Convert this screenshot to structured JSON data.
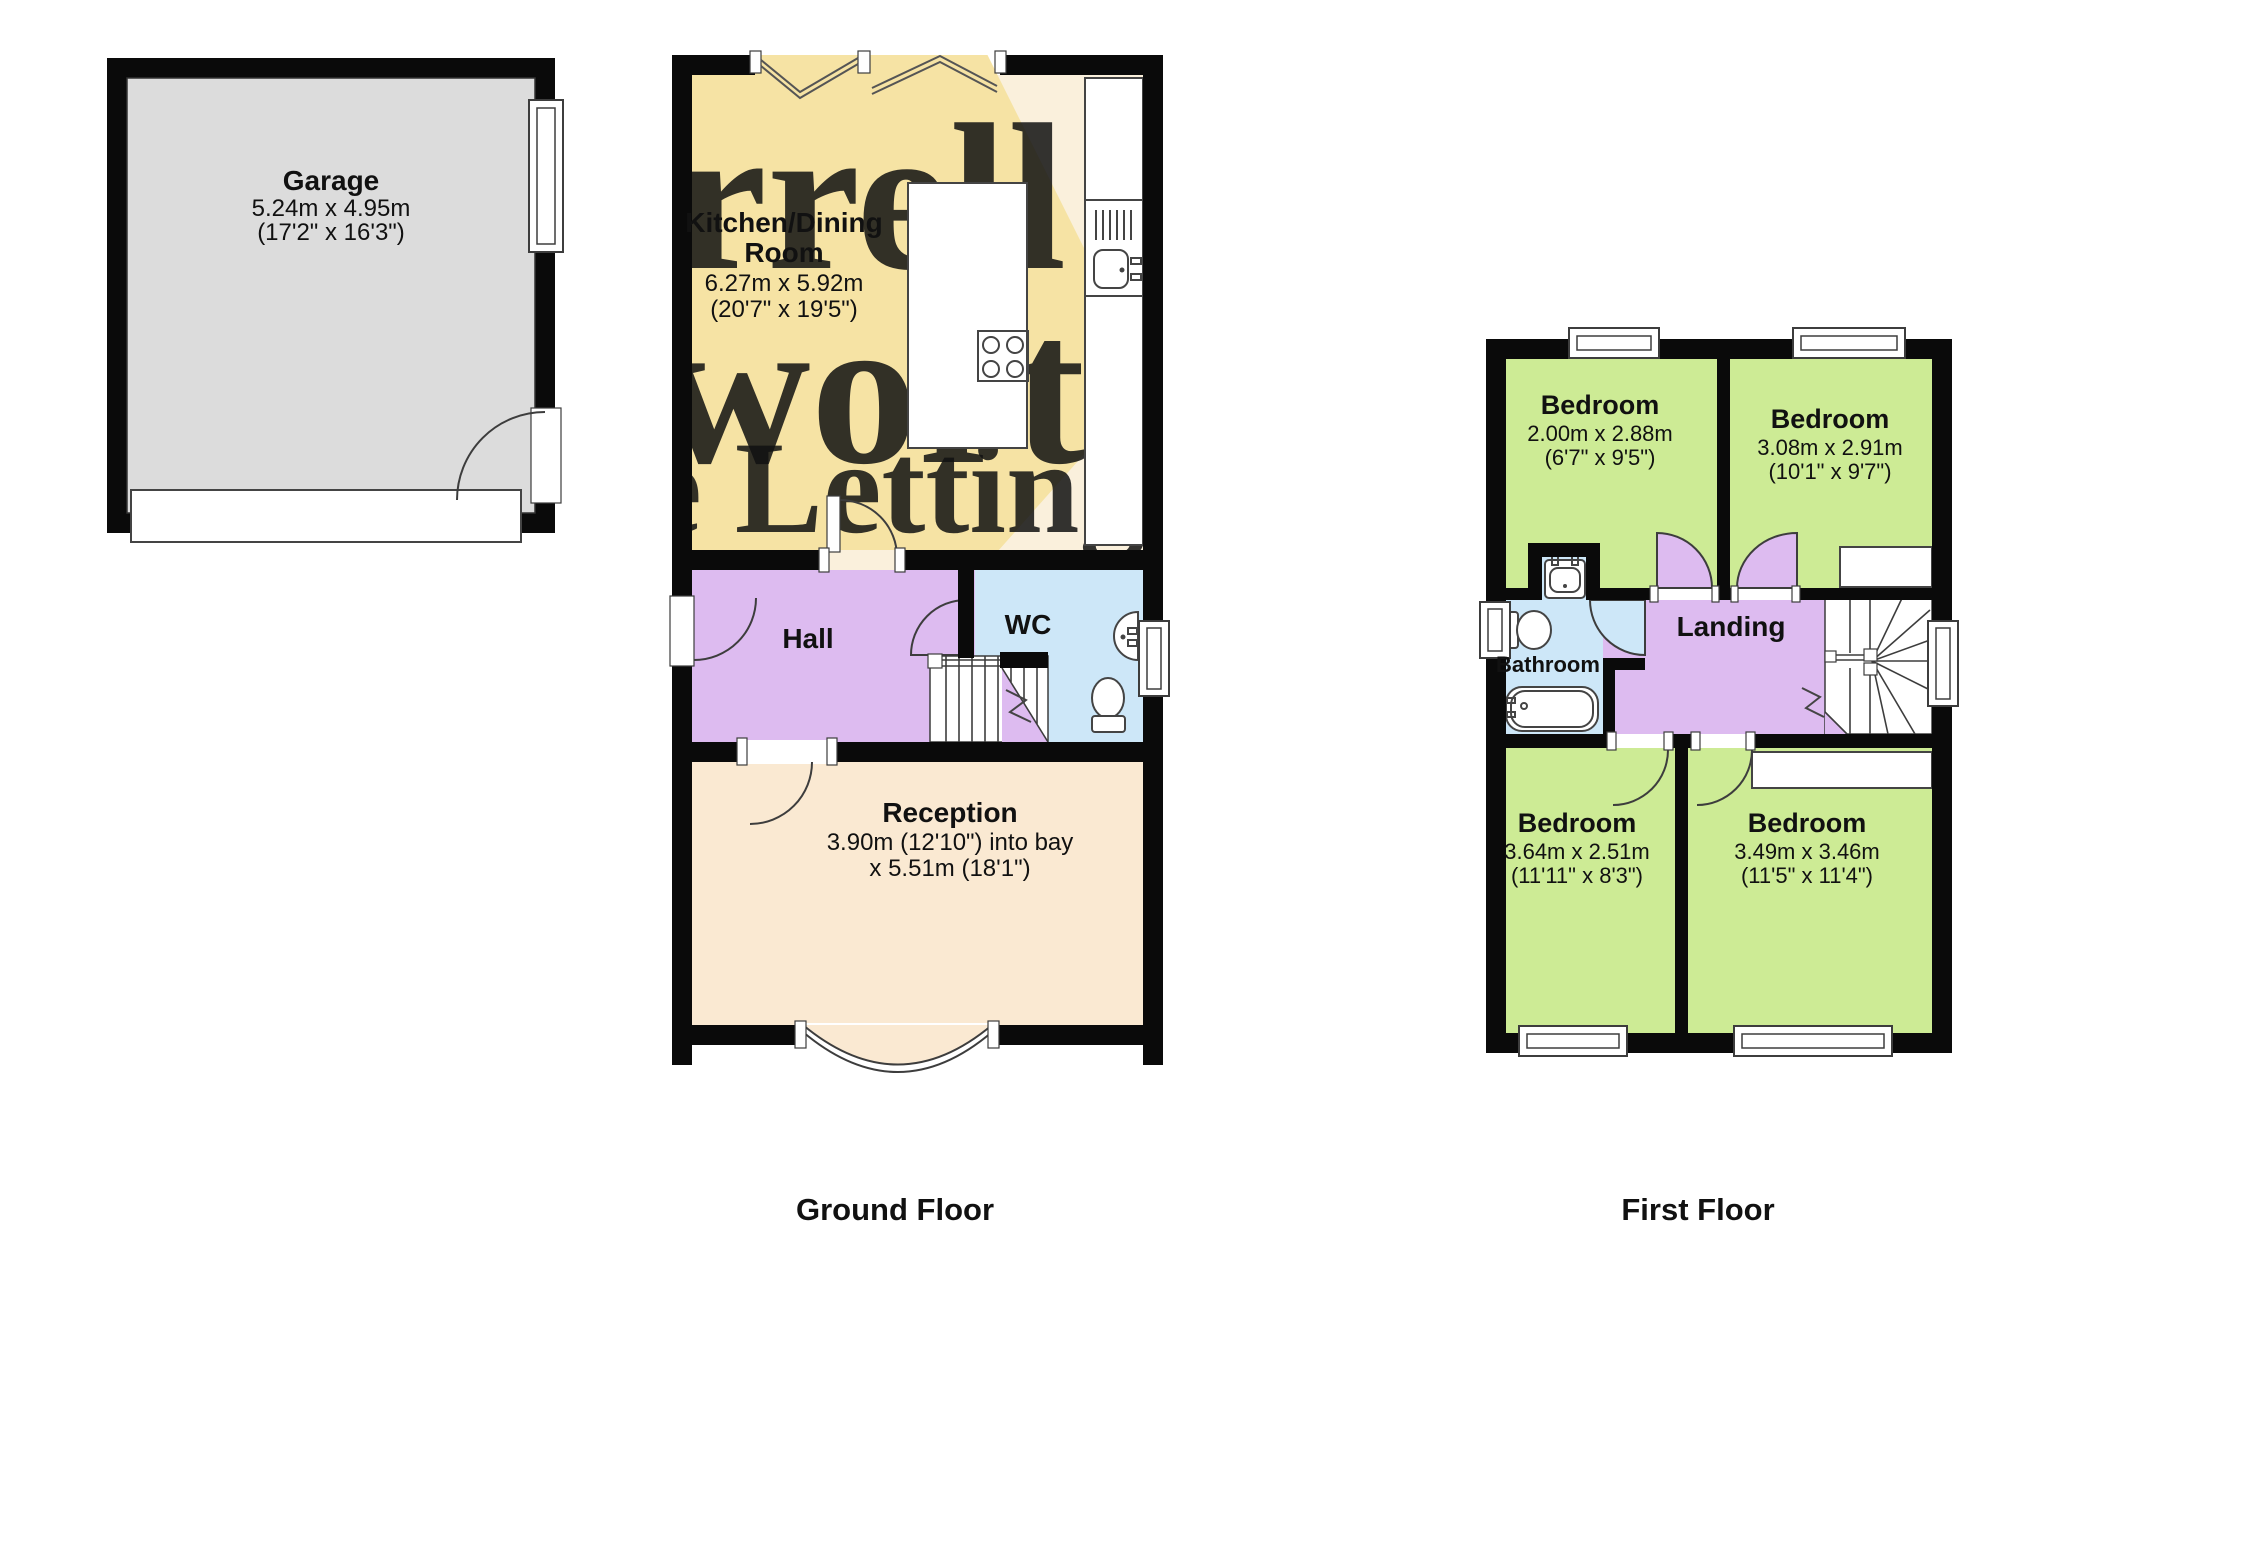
{
  "title": "Floorplan",
  "colors": {
    "wall": "#0a0a0a",
    "garage_gray": "#dcdcdc",
    "kitchen_cream": "#faf0dc",
    "diamond_yellow": "#f6e3a4",
    "reception_cream": "#fae9d2",
    "hall_purple": "#ddbbf0",
    "wc_blue": "#cde7f8",
    "bedroom_green": "#cdeb95",
    "watermark_gray": "#c5bcab",
    "watermark_red": "#f1a49a"
  },
  "watermark": {
    "line1": "rrell",
    "line2": "worth",
    "line3": "e Lettings"
  },
  "ground_floor": {
    "label": "Ground Floor",
    "rooms": {
      "garage": {
        "name": "Garage",
        "dims_m": "5.24m x 4.95m",
        "dims_ft": "(17'2\" x 16'3\")"
      },
      "kitchen": {
        "name_line1": "Kitchen/Dining",
        "name_line2": "Room",
        "dims_m": "6.27m x 5.92m",
        "dims_ft": "(20'7\" x 19'5\")"
      },
      "hall": {
        "name": "Hall"
      },
      "wc": {
        "name": "WC"
      },
      "reception": {
        "name": "Reception",
        "dims_line1": "3.90m (12'10\") into bay",
        "dims_line2": "x 5.51m (18'1\")"
      }
    }
  },
  "first_floor": {
    "label": "First Floor",
    "rooms": {
      "bedroom_top_left": {
        "name": "Bedroom",
        "dims_m": "2.00m x 2.88m",
        "dims_ft": "(6'7\" x 9'5\")"
      },
      "bedroom_top_right": {
        "name": "Bedroom",
        "dims_m": "3.08m x 2.91m",
        "dims_ft": "(10'1\" x 9'7\")"
      },
      "bathroom": {
        "name": "Bathroom"
      },
      "landing": {
        "name": "Landing"
      },
      "bedroom_bottom_left": {
        "name": "Bedroom",
        "dims_m": "3.64m x 2.51m",
        "dims_ft": "(11'11\" x 8'3\")"
      },
      "bedroom_bottom_right": {
        "name": "Bedroom",
        "dims_m": "3.49m x 3.46m",
        "dims_ft": "(11'5\" x 11'4\")"
      }
    }
  }
}
